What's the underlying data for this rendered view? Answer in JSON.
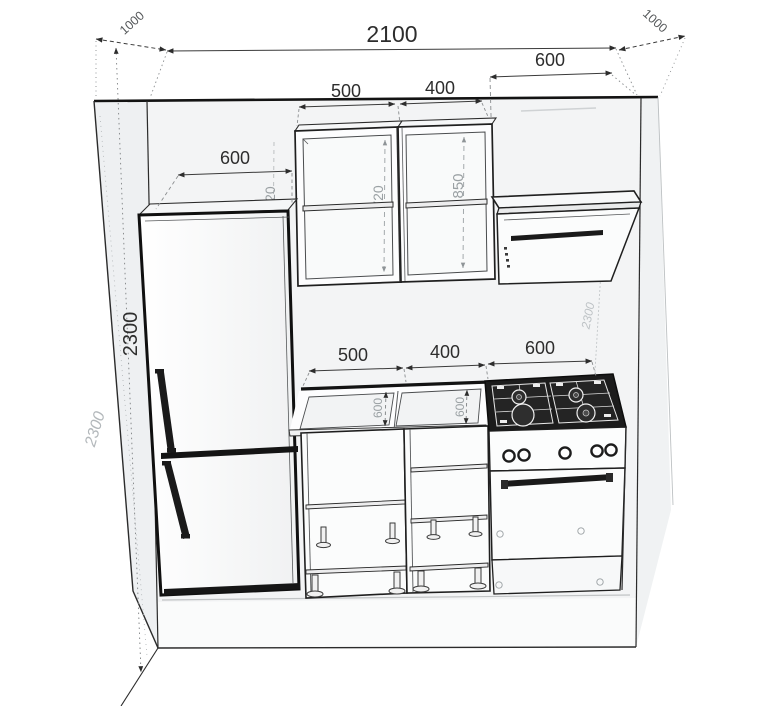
{
  "dims": {
    "room_width": "2100",
    "side_depth_left": "1000",
    "side_depth_right": "1000",
    "room_height": "2300",
    "room_height_outer": "2300",
    "room_height_right": "2300",
    "hood_width": "600",
    "fridge_width": "600",
    "upper_cab_a_width": "500",
    "upper_cab_b_width": "400",
    "upper_cab_a_height": "720",
    "upper_cab_b_height": "850",
    "upper_edge_height": "720",
    "base_cab_a_width": "500",
    "base_cab_b_width": "400",
    "stove_width": "600",
    "counter_depth_a": "600",
    "counter_depth_b": "600"
  },
  "colors": {
    "line": "#2b2b2b",
    "dim_gray": "#9aa0a3",
    "faint_dim": "#b3b8bb",
    "cooktop": "#1c1c1c",
    "wall_fill": "#f3f4f5",
    "floor_fill": "#fafbfb"
  }
}
